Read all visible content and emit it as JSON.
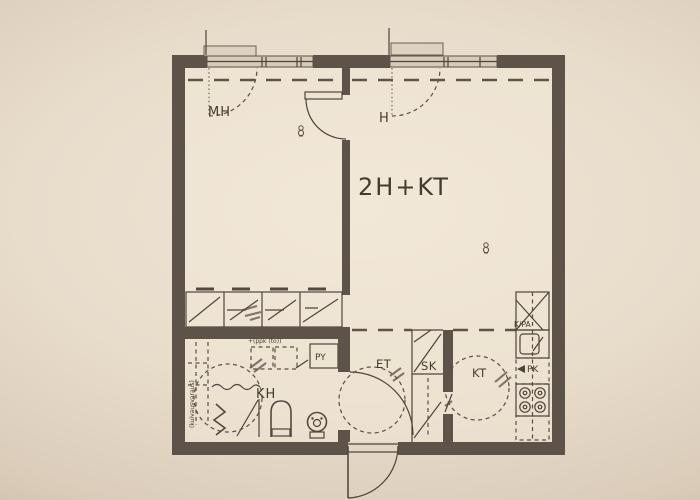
{
  "photo": {
    "background_hex": "#e8dccb",
    "vignette_hex": "#a4967f",
    "ink_hex": "#4e443a",
    "wall_hex": "#5d5348"
  },
  "plan": {
    "apartment_type": "2H+KT",
    "rooms": [
      {
        "id": "mh",
        "label": "MH"
      },
      {
        "id": "h",
        "label": "H"
      },
      {
        "id": "kh",
        "label": "KH"
      },
      {
        "id": "et",
        "label": "ET"
      },
      {
        "id": "sk",
        "label": "SK"
      },
      {
        "id": "kt",
        "label": "KT"
      }
    ],
    "fixtures": {
      "laundry_spot": "PY",
      "fridge_freezer": "K/PA",
      "dishwasher": "PK"
    },
    "annotations": {
      "laundry_note": "+(ppk (to))",
      "reservation_note": "(kuivausvaraus)"
    }
  }
}
